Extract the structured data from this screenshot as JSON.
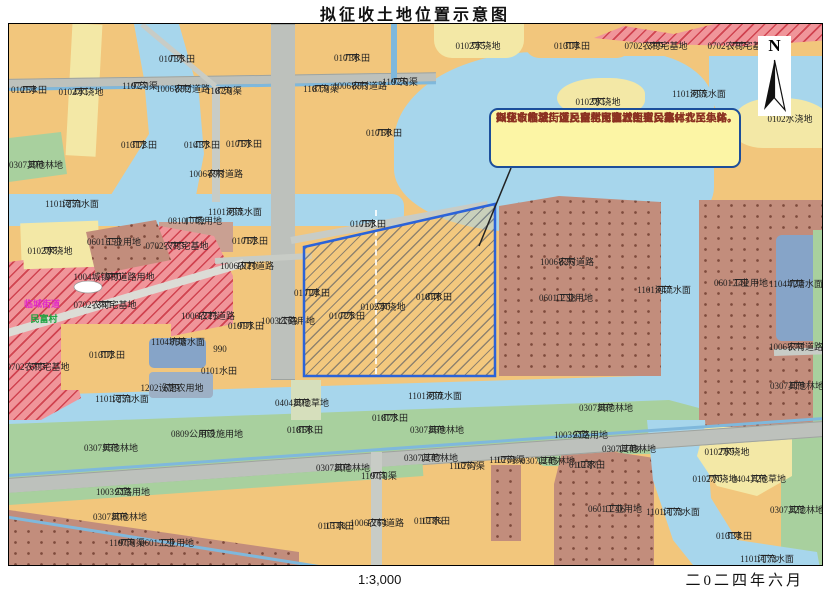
{
  "title": "拟征收土地位置示意图",
  "scale_text": "1:3,000",
  "date_text": "二0二四年六月",
  "north_label": "N",
  "callout": {
    "lines": [
      "拟征收地块：涉及兴化市临城街道民富村农民集体，",
      "兴化市临城街道民富村民富五组农民集体，",
      "兴化市临城街道民富村民富六组农民集体",
      "四至：东至厂区、南至河流、西至公路、北至小路。"
    ]
  },
  "colors": {
    "farmland": "#F2C67C",
    "irrigated": "#F3E8A6",
    "water": "#A7D6EC",
    "pond": "#86A4C8",
    "forest": "#A8D09E",
    "grass": "#D6DFBC",
    "homestead_red": "#F0959A",
    "industrial": "#C28D7C",
    "road": "#BDC1BC",
    "subject_border": "#2B63D9",
    "callout_bg": "#FCF5A5",
    "callout_border": "#1C4E9A",
    "callout_text": "#8C3222",
    "place_magenta": "#E028C8",
    "place_green": "#16A23C"
  },
  "map": {
    "labels": [
      {
        "x": 20,
        "y": 61,
        "n": "254",
        "t": "0101水田"
      },
      {
        "x": 72,
        "y": 63,
        "n": "441",
        "t": "0102水浇地"
      },
      {
        "x": 168,
        "y": 30,
        "n": "735",
        "t": "0101水田"
      },
      {
        "x": 131,
        "y": 57,
        "n": "927",
        "t": "1107沟渠"
      },
      {
        "x": 174,
        "y": 60,
        "n": "882",
        "t": "1006农村道路"
      },
      {
        "x": 130,
        "y": 116,
        "n": "312",
        "t": "0101水田"
      },
      {
        "x": 193,
        "y": 116,
        "n": "433",
        "t": "0101水田"
      },
      {
        "x": 27,
        "y": 136,
        "n": "390",
        "t": "0307其他林地"
      },
      {
        "x": 63,
        "y": 175,
        "n": "1251",
        "t": "1101河流水面"
      },
      {
        "x": 207,
        "y": 145,
        "n": "498",
        "t": "1006农村道路"
      },
      {
        "x": 343,
        "y": 29,
        "n": "736",
        "t": "0101水田"
      },
      {
        "x": 215,
        "y": 62,
        "n": "820",
        "t": "1107沟渠"
      },
      {
        "x": 312,
        "y": 60,
        "n": "819",
        "t": "1107沟渠"
      },
      {
        "x": 351,
        "y": 57,
        "n": "883",
        "t": "1006农村道路"
      },
      {
        "x": 391,
        "y": 53,
        "n": "926",
        "t": "1107沟渠"
      },
      {
        "x": 235,
        "y": 115,
        "n": "761",
        "t": "0101水田"
      },
      {
        "x": 375,
        "y": 104,
        "n": "760",
        "t": "0101水田"
      },
      {
        "x": 226,
        "y": 183,
        "n": "893",
        "t": "1101河流水面"
      },
      {
        "x": 469,
        "y": 17,
        "n": "345",
        "t": "0102水浇地"
      },
      {
        "x": 563,
        "y": 17,
        "n": "304",
        "t": "0101水田"
      },
      {
        "x": 647,
        "y": 17,
        "n": "389",
        "t": "0702农村宅基地"
      },
      {
        "x": 730,
        "y": 17,
        "n": "737",
        "t": "0702农村宅基地"
      },
      {
        "x": 690,
        "y": 65,
        "n": "895",
        "t": "1101河流水面"
      },
      {
        "x": 589,
        "y": 73,
        "n": "381",
        "t": "0102水浇地"
      },
      {
        "x": 781,
        "y": 90,
        "t": "0102水浇地"
      },
      {
        "x": 41,
        "y": 222,
        "n": "398",
        "t": "0102水浇地"
      },
      {
        "x": 105,
        "y": 213,
        "n": "653",
        "t": "0601工业用地"
      },
      {
        "x": 105,
        "y": 248,
        "n": "980",
        "t": "1004城镇村道路用地"
      },
      {
        "x": 96,
        "y": 276,
        "n": "341",
        "t": "0702农村宅基地"
      },
      {
        "x": 33,
        "y": 275,
        "t": "临城街道",
        "c": "mag"
      },
      {
        "x": 35,
        "y": 290,
        "t": "民富村",
        "c": "grn"
      },
      {
        "x": 98,
        "y": 326,
        "n": "302",
        "t": "0101水田"
      },
      {
        "x": 29,
        "y": 338,
        "n": "603",
        "t": "0702农村宅基地"
      },
      {
        "x": 168,
        "y": 217,
        "n": "783",
        "t": "0702农村宅基地"
      },
      {
        "x": 186,
        "y": 192,
        "n": "1002",
        "t": "0810广场用地"
      },
      {
        "x": 241,
        "y": 212,
        "n": "762",
        "t": "0101水田"
      },
      {
        "x": 238,
        "y": 237,
        "n": "1020",
        "t": "1006农村道路"
      },
      {
        "x": 199,
        "y": 287,
        "n": "1225",
        "t": "1006农村道路"
      },
      {
        "x": 169,
        "y": 313,
        "n": "858",
        "t": "1104坑塘水面"
      },
      {
        "x": 237,
        "y": 297,
        "n": "991",
        "t": "0101水田"
      },
      {
        "x": 211,
        "y": 320,
        "t": "990"
      },
      {
        "x": 279,
        "y": 292,
        "n": "1168",
        "t": "1003公路用地"
      },
      {
        "x": 210,
        "y": 342,
        "t": "0101水田"
      },
      {
        "x": 558,
        "y": 233,
        "n": "826",
        "t": "1006农村道路"
      },
      {
        "x": 557,
        "y": 269,
        "n": "1238",
        "t": "0601工业用地"
      },
      {
        "x": 655,
        "y": 261,
        "n": "847",
        "t": "1101河流水面"
      },
      {
        "x": 732,
        "y": 254,
        "n": "742",
        "t": "0601工业用地"
      },
      {
        "x": 787,
        "y": 255,
        "n": "424",
        "t": "1104坑塘水面"
      },
      {
        "x": 787,
        "y": 318,
        "n": "574",
        "t": "1006农村道路"
      },
      {
        "x": 788,
        "y": 357,
        "n": "419",
        "t": "0307其他林地"
      },
      {
        "x": 303,
        "y": 264,
        "n": "724",
        "t": "0101水田"
      },
      {
        "x": 338,
        "y": 287,
        "n": "725",
        "t": "0101水田"
      },
      {
        "x": 374,
        "y": 278,
        "n": "540",
        "t": "0102水浇地"
      },
      {
        "x": 425,
        "y": 268,
        "n": "846",
        "t": "0101水田"
      },
      {
        "x": 359,
        "y": 195,
        "n": "763",
        "t": "0101水田"
      },
      {
        "x": 426,
        "y": 367,
        "n": "890",
        "t": "1101河流水面"
      },
      {
        "x": 293,
        "y": 374,
        "n": "892",
        "t": "0404其他草地"
      },
      {
        "x": 296,
        "y": 401,
        "n": "866",
        "t": "0101水田"
      },
      {
        "x": 381,
        "y": 389,
        "n": "873",
        "t": "0101水田"
      },
      {
        "x": 428,
        "y": 401,
        "n": "869",
        "t": "0307其他林地"
      },
      {
        "x": 422,
        "y": 429,
        "n": "1247",
        "t": "0307其他林地"
      },
      {
        "x": 334,
        "y": 439,
        "n": "804",
        "t": "0307其他林地"
      },
      {
        "x": 370,
        "y": 447,
        "n": "901",
        "t": "1107沟渠"
      },
      {
        "x": 458,
        "y": 437,
        "n": "1267",
        "t": "1107沟渠"
      },
      {
        "x": 498,
        "y": 431,
        "n": "1268",
        "t": "1107沟渠"
      },
      {
        "x": 327,
        "y": 497,
        "n": "1348",
        "t": "0101水田"
      },
      {
        "x": 368,
        "y": 494,
        "n": "1264",
        "t": "1006农村道路"
      },
      {
        "x": 423,
        "y": 492,
        "n": "1286",
        "t": "0101水田"
      },
      {
        "x": 113,
        "y": 370,
        "n": "1251",
        "t": "1101河流水面"
      },
      {
        "x": 163,
        "y": 359,
        "n": "629",
        "t": "1202设施农用地"
      },
      {
        "x": 102,
        "y": 419,
        "n": "953",
        "t": "0307其他林地"
      },
      {
        "x": 198,
        "y": 405,
        "n": "503",
        "t": "0809公用设施用地"
      },
      {
        "x": 114,
        "y": 463,
        "n": "913",
        "t": "1003公路用地"
      },
      {
        "x": 111,
        "y": 488,
        "n": "806",
        "t": "0307其他林地"
      },
      {
        "x": 118,
        "y": 514,
        "n": "900",
        "t": "1107沟渠"
      },
      {
        "x": 158,
        "y": 514,
        "n": "729",
        "t": "0601工业用地"
      },
      {
        "x": 597,
        "y": 379,
        "n": "867",
        "t": "0307其他林地"
      },
      {
        "x": 572,
        "y": 406,
        "n": "912",
        "t": "1003公路用地"
      },
      {
        "x": 620,
        "y": 420,
        "n": "1248",
        "t": "0307其他林地"
      },
      {
        "x": 539,
        "y": 432,
        "n": "1245",
        "t": "0307其他林地"
      },
      {
        "x": 578,
        "y": 436,
        "n": "1287",
        "t": "0101水田"
      },
      {
        "x": 718,
        "y": 423,
        "n": "769",
        "t": "0102水浇地"
      },
      {
        "x": 706,
        "y": 450,
        "n": "770",
        "t": "0102水浇地"
      },
      {
        "x": 750,
        "y": 450,
        "n": "726",
        "t": "0404其他草地"
      },
      {
        "x": 788,
        "y": 481,
        "n": "322",
        "t": "0307其他林地"
      },
      {
        "x": 664,
        "y": 483,
        "n": "1173",
        "t": "1101河流水面"
      },
      {
        "x": 606,
        "y": 480,
        "n": "1246",
        "t": "0601工业用地"
      },
      {
        "x": 725,
        "y": 507,
        "n": "334",
        "t": "0101水田"
      },
      {
        "x": 758,
        "y": 530,
        "n": "1173",
        "t": "1101河流水面"
      }
    ]
  }
}
